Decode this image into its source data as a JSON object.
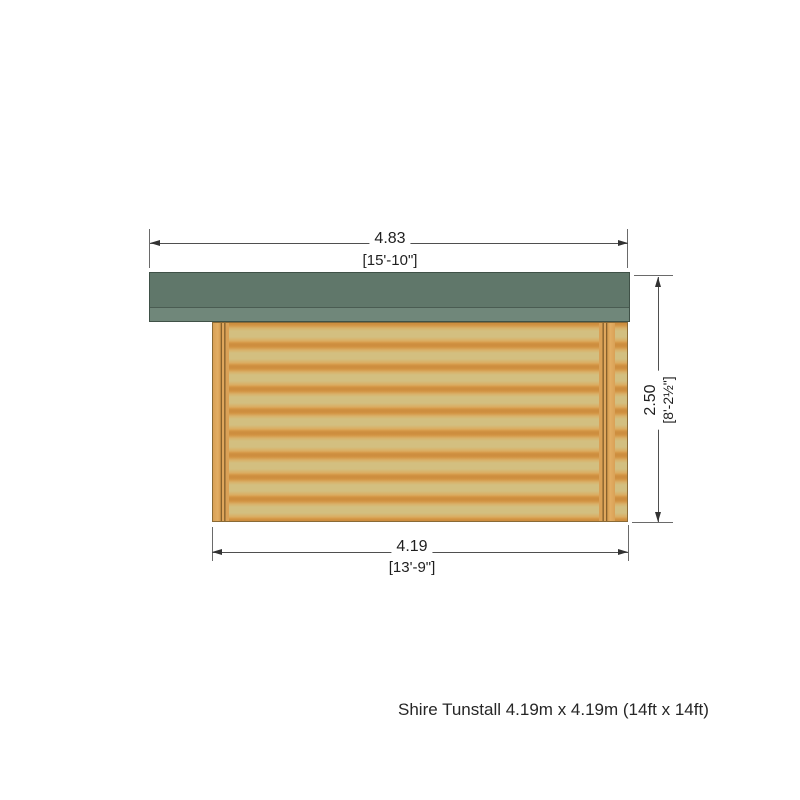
{
  "colors": {
    "roof_dark": "#60776a",
    "roof_light": "#70877a",
    "roof_outline": "#3f5147",
    "wall_light": "#d3bf80",
    "wall_orange": "#dfa250",
    "wall_outline": "#8a6a35",
    "batten_line": "#7d5a28",
    "dim_line": "#4f4f4f",
    "text": "#1f1f1f"
  },
  "dimensions": {
    "roof_width": {
      "metric": "4.83",
      "imperial": "[15'-10\"]"
    },
    "wall_width": {
      "metric": "4.19",
      "imperial": "[13'-9\"]"
    },
    "height": {
      "metric": "2.50",
      "imperial": "[8'-2½\"]"
    }
  },
  "caption": "Shire Tunstall 4.19m x 4.19m (14ft x 14ft)"
}
